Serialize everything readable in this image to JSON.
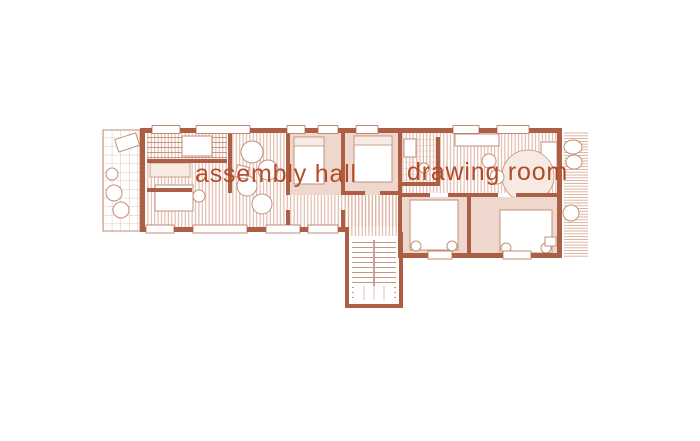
{
  "page": {
    "background": "#ffffff"
  },
  "plan": {
    "type": "architectural-floor-plan",
    "labels": {
      "assembly_hall": "assembly hall",
      "drawing_room": "drawing room"
    },
    "features": [
      "veranda",
      "stair-room",
      "sitting-chairs",
      "bedrooms",
      "corridor",
      "staircase",
      "bathroom",
      "round-table",
      "terrace"
    ]
  },
  "colors": {
    "label_text": "#b34a28",
    "wall": "#ad5f45",
    "wall_light": "#c28b76",
    "floor_hatch": "#dcae9c",
    "soft_fill": "#eed8cd",
    "grid_line": "#d9b3a1",
    "furniture_line": "#c49078",
    "background": "#ffffff"
  }
}
